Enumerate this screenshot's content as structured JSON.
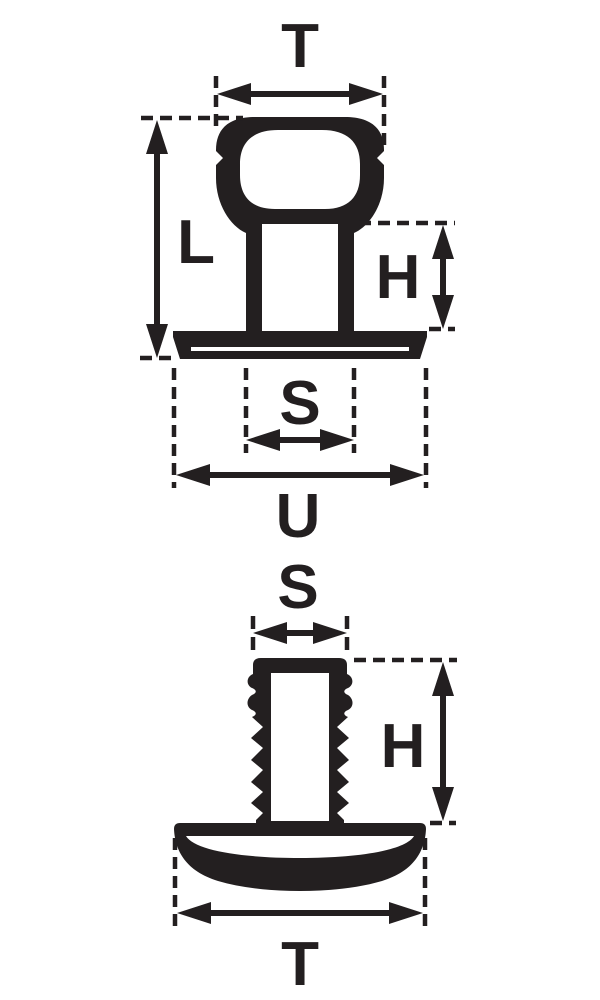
{
  "colors": {
    "ink": "#231f20",
    "background": "#ffffff"
  },
  "figures": {
    "top": {
      "labels": {
        "t": "T",
        "l": "L",
        "h": "H",
        "s": "S",
        "u": "U"
      }
    },
    "bottom": {
      "labels": {
        "s": "S",
        "h": "H",
        "t": "T"
      }
    }
  }
}
